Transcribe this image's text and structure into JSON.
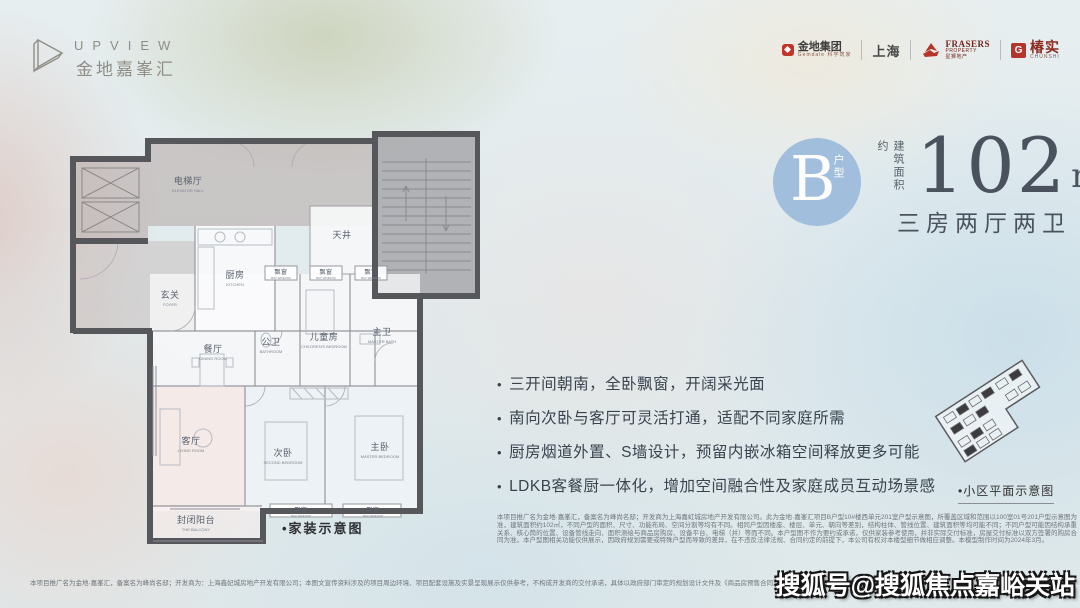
{
  "brand": {
    "name": "UPVIEW",
    "subtitle": "金地嘉峯汇"
  },
  "partners": {
    "gemdale": {
      "name": "金地集团",
      "sub": "Gemdale 科学筑家"
    },
    "shanghai": "上海",
    "frasers": {
      "name": "FRASERS",
      "name2": "PROPERTY",
      "sub": "星狮地产"
    },
    "chunshi": {
      "name": "椿实",
      "icon_letter": "G",
      "sub": "CHUNSHI"
    }
  },
  "unit": {
    "type_letter": "B",
    "type_label": "户型",
    "area_prefix": "建筑面积约",
    "area_value": "102",
    "area_unit": "m",
    "area_sup": "2",
    "layout": "三房两厅两卫"
  },
  "features": [
    "三开间朝南，全卧飘窗，开阔采光面",
    "南向次卧与客厅可灵活打通，适配不同家庭所需",
    "厨房烟道外置、S墙设计，预留内嵌冰箱空间释放更多可能",
    "LDKB客餐厨一体化，增加空间融合性及家庭成员互动场景感"
  ],
  "floorplan": {
    "caption": "•家装示意图",
    "rooms": [
      {
        "zh": "电梯厅",
        "en": "ELEVATOR HALL",
        "x": 128,
        "y": 58,
        "s": 0
      },
      {
        "zh": "天井",
        "en": "",
        "x": 282,
        "y": 112,
        "s": 0
      },
      {
        "zh": "厨房",
        "en": "KITCHEN",
        "x": 175,
        "y": 152,
        "s": 0
      },
      {
        "zh": "玄关",
        "en": "FOYER",
        "x": 110,
        "y": 172,
        "s": 0
      },
      {
        "zh": "飘窗",
        "en": "BAY WINDOW",
        "x": 221,
        "y": 148,
        "s": 1
      },
      {
        "zh": "飘窗",
        "en": "BAY WINDOW",
        "x": 266,
        "y": 148,
        "s": 1
      },
      {
        "zh": "飘窗",
        "en": "BAY WINDOW",
        "x": 311,
        "y": 148,
        "s": 1
      },
      {
        "zh": "餐厅",
        "en": "DINING ROOM",
        "x": 153,
        "y": 226,
        "s": 0
      },
      {
        "zh": "公卫",
        "en": "BATHROOM",
        "x": 211,
        "y": 219,
        "s": 0
      },
      {
        "zh": "儿童房",
        "en": "CHILDREN'S BEDROOM",
        "x": 264,
        "y": 214,
        "s": 0
      },
      {
        "zh": "主卫",
        "en": "MASTER BATH",
        "x": 322,
        "y": 209,
        "s": 0
      },
      {
        "zh": "客厅",
        "en": "LIVING ROOM",
        "x": 131,
        "y": 318,
        "s": 0
      },
      {
        "zh": "次卧",
        "en": "SECOND BEDROOM",
        "x": 223,
        "y": 330,
        "s": 0
      },
      {
        "zh": "主卧",
        "en": "MASTER BEDROOM",
        "x": 320,
        "y": 324,
        "s": 0
      },
      {
        "zh": "飘窗",
        "en": "BAY WINDOW",
        "x": 241,
        "y": 386,
        "s": 1
      },
      {
        "zh": "飘窗",
        "en": "BAY WINDOW",
        "x": 313,
        "y": 386,
        "s": 1
      },
      {
        "zh": "封闭阳台",
        "en": "THE BALCONY",
        "x": 136,
        "y": 397,
        "s": 0
      }
    ]
  },
  "siteplan": {
    "caption": "•小区平面示意图"
  },
  "disclaimer": "本项目推广名为金地·嘉峯汇，备案名为峰尚名邸；开发商为上海嘉虹城房地产开发有限公司。此为金地·嘉峯汇项目B户型10#楼西单元201室户型示意图，所覆盖区域和范围以100室01号201户型示意图为准，建筑面积约102㎡，不同户型的面积、尺寸、功能布局、空间分割等均有不同。相同户型因楼座、楼层、单元、朝向等差别，结构柱体、管线位置、建筑面积等均可能不同；不同户型可能因结构承重关系、核心筒的位置、设备管线走向、面积测绘与商品房购房、设备平台、电梯（井）等而不同。本户型图不作为要约或承诺，仅供家装参考使用，并非实际交付标准，房屋交付标准以双方签署的购房合同为准。本户型图相关功能仅供展示，因政府规划需要或特殊户型而导致的差异，在不违反法律法规、合同约定的前提下，本公司有权对本楼型细节做相应调整。本模型制作时间为2024年3月。",
  "footer": "本项目推广名为金地·嘉峯汇，备案名为峰尚名邸；开发商为：上海鑫妃城房地产开发有限公司；本图文宣传资料涉及的项目周边环境、项目配套设施及实景呈现展示仅供参考，不构成开发商的交付承诺，具体以政府部门审定的规划设计文件及《商品房预售合同》的约定为准。本宣传资料制作时间为2024年3月。",
  "watermark": "搜狐号@搜狐焦点嘉峪关站",
  "colors": {
    "accent_blue": "#a1bedd",
    "brand_red": "#c03527",
    "dark_text": "#49525d"
  }
}
